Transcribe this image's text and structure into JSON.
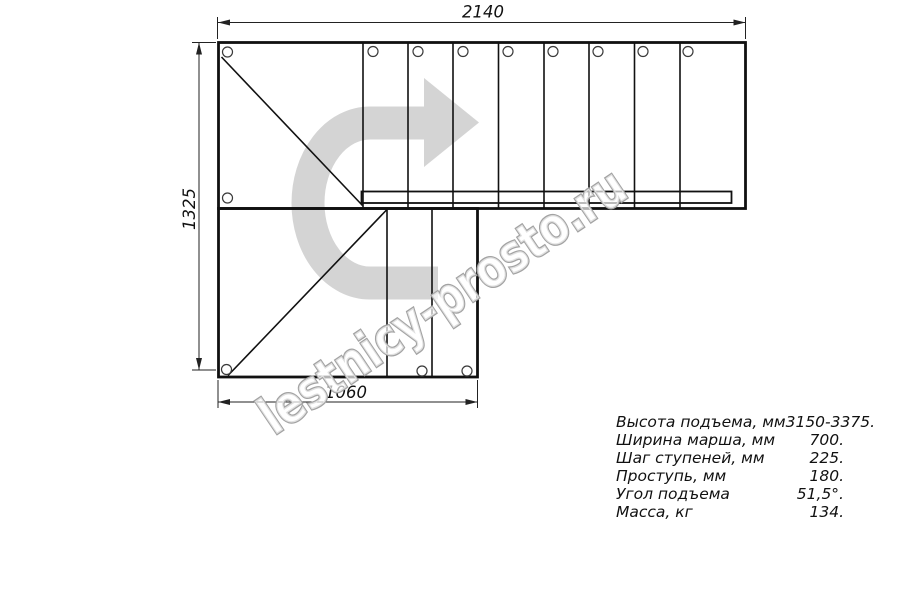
{
  "watermark": {
    "text": "lestnicy-prosto.ru"
  },
  "dimensions": {
    "top_width_mm": "2140",
    "left_height_mm": "1325",
    "bottom_width_mm": "1060"
  },
  "specs": {
    "rows": [
      {
        "label": "Высота подъема, мм",
        "value": "3150-3375."
      },
      {
        "label": "Ширина марша, мм",
        "value": "700."
      },
      {
        "label": "Шаг ступеней, мм",
        "value": "225."
      },
      {
        "label": "Проступь, мм",
        "value": "180."
      },
      {
        "label": "Угол подъема",
        "value": "51,5°."
      },
      {
        "label": "Масса, кг",
        "value": "134."
      }
    ]
  },
  "colors": {
    "line": "#111111",
    "dimension": "#222222",
    "arrow_fill": "#d4d4d4",
    "watermark_outline": "#a3a3a3"
  }
}
